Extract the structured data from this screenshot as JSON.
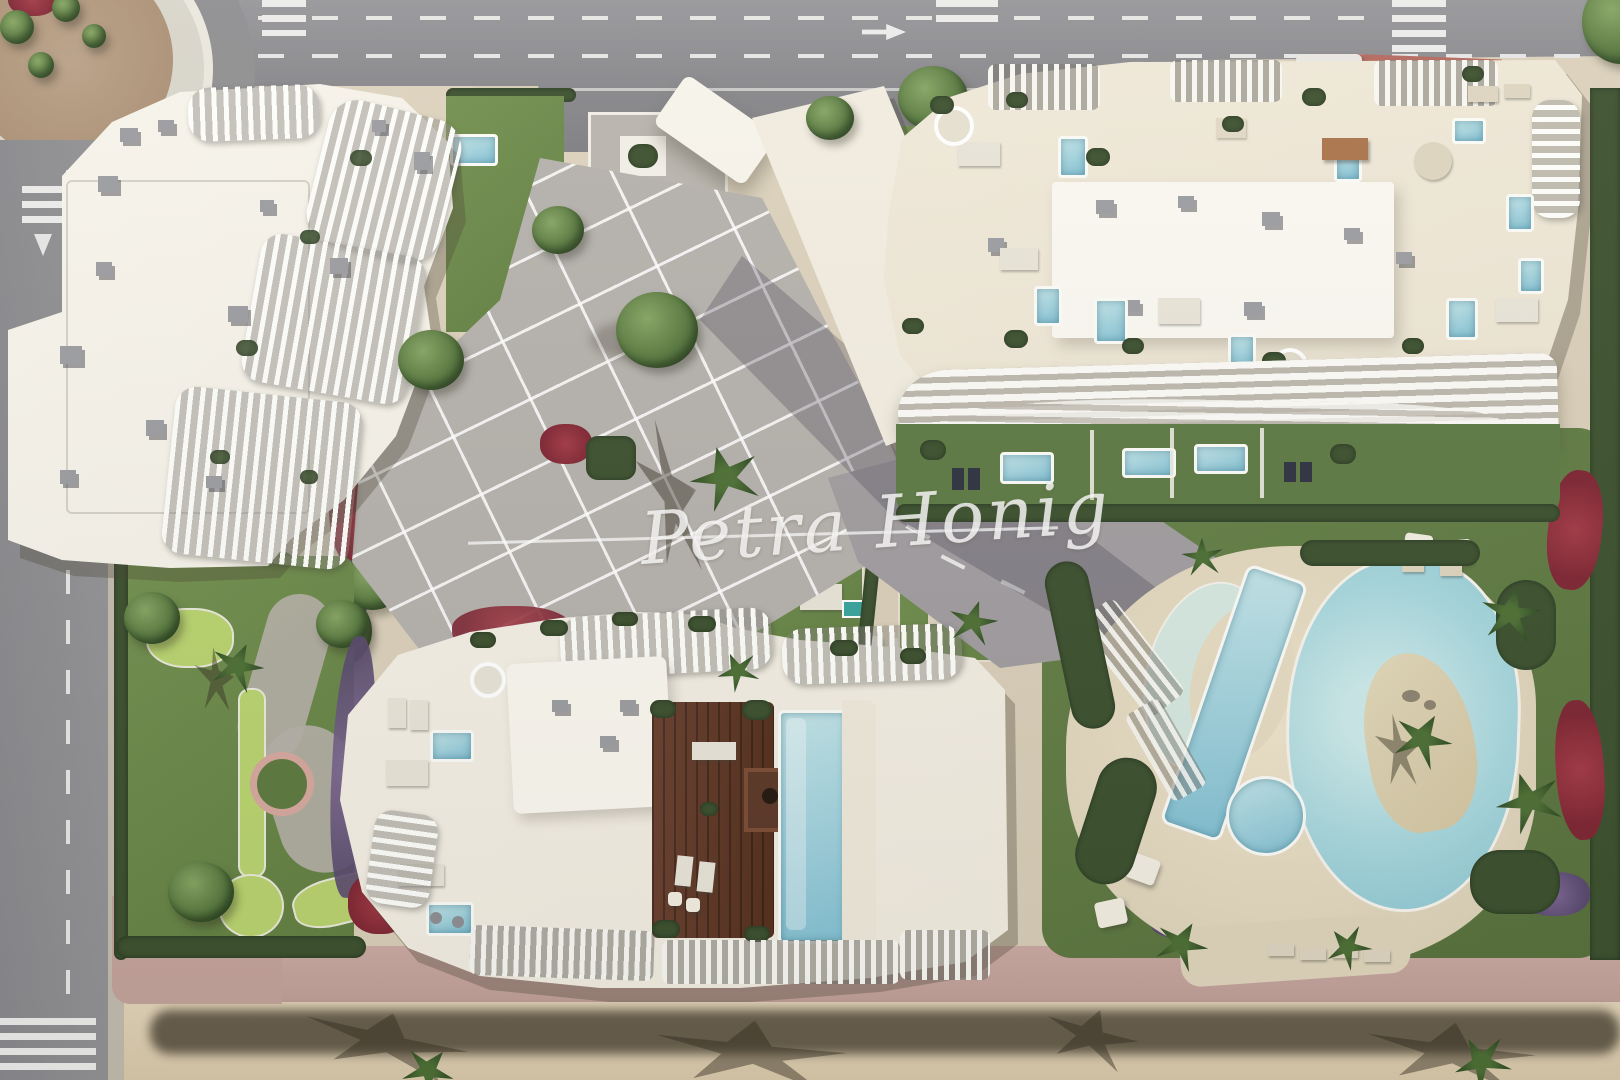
{
  "image": {
    "type": "aerial-3d-render",
    "description": "Top-down architectural render of a beachfront residential complex: three sculptural white apartment buildings with rooftop terraces and plunge pools, communal lagoon pool area, mini-golf garden, landscaped plazas and a sandy beach promenade"
  },
  "watermark": {
    "text": "Petra Honig",
    "underline": true
  },
  "palette": {
    "asphalt": "#8D8D8F",
    "road_marking": "#EAEAE8",
    "sidewalk": "#C2BBAE",
    "pink_path": "#C9A8A2",
    "parcel_sand": "#DCD2BD",
    "beach_sand": "#E0D2B6",
    "lawn": "#6E8B4E",
    "putting_green": "#B9D36F",
    "hedge": "#3D5230",
    "flowers_red": "#96303E",
    "flowers_purple": "#6D5A80",
    "building_white": "#F6F3EA",
    "roof_cream": "#EFE8D8",
    "ac_gray": "#9C9DA1",
    "wood_deck": "#63402C",
    "pool_water": "#8EC6D8",
    "pool_shallow": "#C8E6E4",
    "lagoon_island_sand": "#DDD2B4",
    "red_island": "#B4695E",
    "shadow": "#4A4438"
  },
  "scene": {
    "roads": {
      "top_road": "horizontal avenue with dashed lanes and right-turn arrow",
      "left_road": "vertical street with dashed center line",
      "roundabout": "top-left with desert planting",
      "crosswalks": 4,
      "vehicle": "white minibus at top right"
    },
    "buildings": [
      {
        "id": "north-west",
        "style": "white roof with cascading curved balcony fins",
        "rooftop": "AC units and pergola terraces"
      },
      {
        "id": "north-east",
        "style": "wavy stacked terrace strata",
        "rooftop": "terraces with plunge pools, pergolas and lounges",
        "ground_floor_private_pools": 3
      },
      {
        "id": "south",
        "style": "curved slatted crown",
        "rooftop": "wooden deck terrace with pavilion and infinity pool"
      }
    ],
    "amenities": {
      "lagoon_pool_with_sand_island": 1,
      "lap_pool": 1,
      "crescent_leisure_pool": 1,
      "round_kids_pool": 1,
      "mini_golf_garden": true,
      "beach_promenade": true
    },
    "vegetation": {
      "palm_trees": true,
      "trimmed_hedges": true,
      "red_flower_beds": true,
      "purple_flower_beds": true,
      "lawns": true
    }
  }
}
